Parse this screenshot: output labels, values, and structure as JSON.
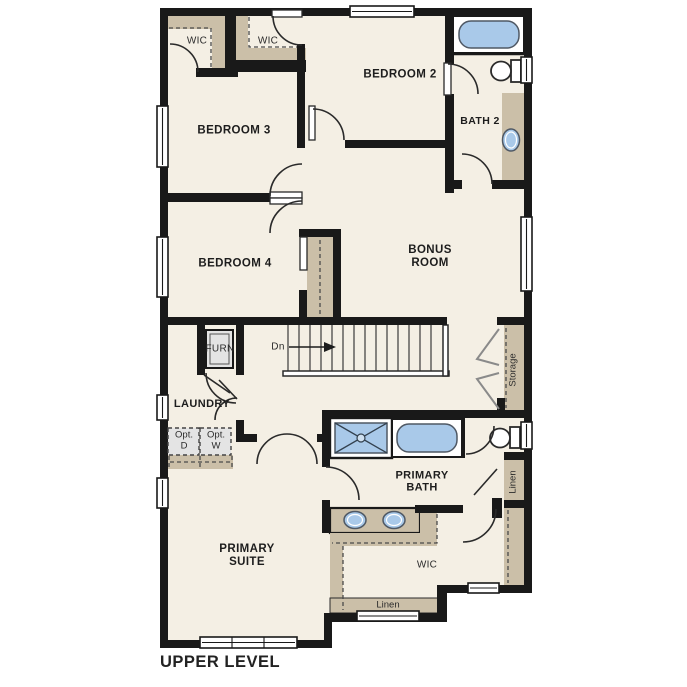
{
  "title": "UPPER LEVEL",
  "rooms": {
    "bedroom2": "BEDROOM 2",
    "bedroom3": "BEDROOM 3",
    "bedroom4": "BEDROOM 4",
    "bonus_room": "BONUS ROOM",
    "bath2": "BATH 2",
    "primary_suite": "PRIMARY SUITE",
    "primary_bath": "PRIMARY BATH",
    "laundry": "LAUNDRY",
    "wic_bedroom3": "WIC",
    "wic_bedroom2": "WIC",
    "wic_primary": "WIC",
    "storage": "Storage",
    "linen_bath_hall": "Linen",
    "linen_wic": "Linen",
    "furnace": "FURN"
  },
  "annotations": {
    "stairs_direction": "Dn",
    "optional_dryer": "Opt. D",
    "optional_washer": "Opt. W"
  },
  "colors": {
    "wall": "#191919",
    "floor": "#f4efe4",
    "casework": "#cbbfa8",
    "fixture_blue": "#a9c9e9",
    "appliance_gray": "#e4e4e4"
  }
}
